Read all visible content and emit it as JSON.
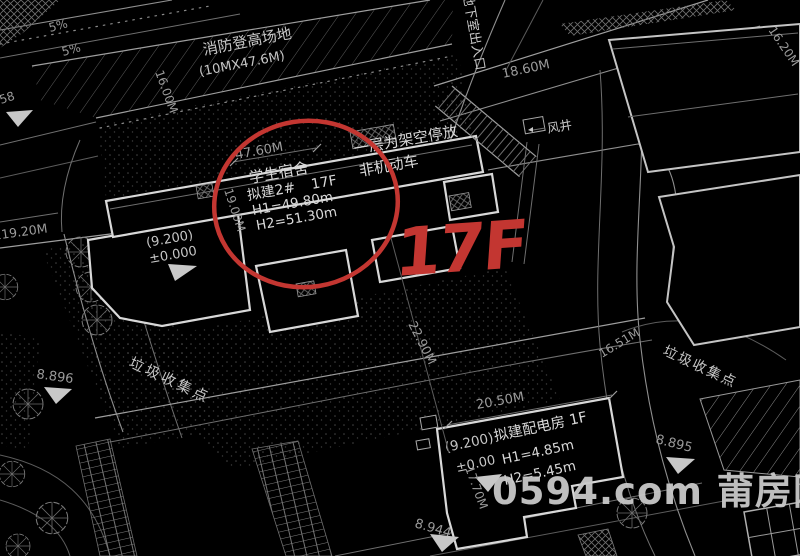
{
  "colors": {
    "background": "#000000",
    "linework": "#8f8f8f",
    "linework_bright": "#d8d8d8",
    "annotation_red": "#c33631",
    "watermark_gray": "#c9c9c9"
  },
  "watermark": {
    "text": "0594.com 莆房网"
  },
  "red_annotation": {
    "label": "17F"
  },
  "fire_lane": {
    "name": "消防登高场地",
    "size": "(10MX47.6M)"
  },
  "slope_labels": {
    "upper": "5%",
    "lower": "5%"
  },
  "dormitory": {
    "name": "学生宿舍",
    "plan_no": "拟建2#",
    "floors": "17F",
    "height1": "H1=49.80m",
    "height2": "H2=51.30m",
    "elevation": "(9.200)",
    "datum": "±0.000"
  },
  "parking_note": {
    "line1": "一层为架空停放",
    "line2": "非机动车"
  },
  "power_house": {
    "elevation": "(9.200)",
    "name": "拟建配电房 1F",
    "datum": "±0.00",
    "height1": "H1=4.85m",
    "height2": "H2=5.45m"
  },
  "labels": {
    "basement_entrance": "地下室出入口",
    "wind_shaft": "风井",
    "garbage_left": "垃圾收集点",
    "garbage_right": "垃圾收集点"
  },
  "dims": {
    "d47_60": "47.60M",
    "d16_00": "16.00M",
    "d19_00": "19.00M",
    "d119_20": "119.20M",
    "d18_60": "18.60M",
    "d16_20": "16.20M",
    "d22_90": "22.90M",
    "d16_51": "16.51M",
    "d20_50": "20.50M",
    "d17_70": "17.70M"
  },
  "spots": {
    "s58": "58",
    "s8_896": "8.896",
    "s8_944": "8.944",
    "s8_895": "8.895"
  }
}
